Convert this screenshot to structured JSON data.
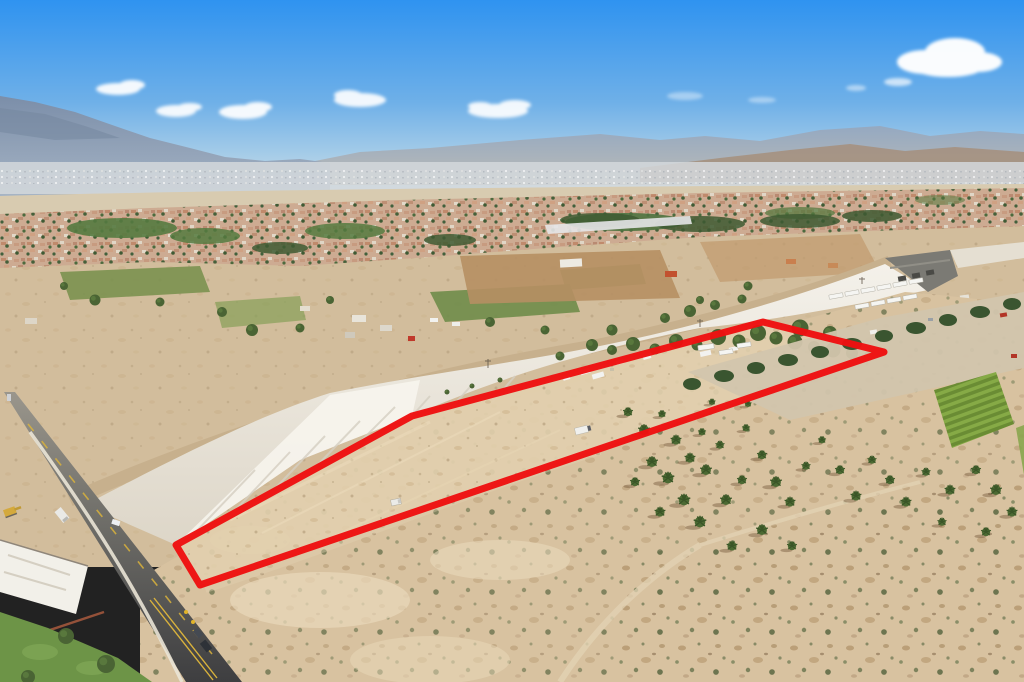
{
  "image": {
    "kind": "aerial-drone-photograph",
    "description": "Aerial view of a vacant desert land parcel outlined in red, running alongside a concrete flood-control channel, with palm groves and a trailer yard to the right, a two-lane road lower left, and a desert suburb with mountains under a blue sky in the background",
    "width_px": 1024,
    "height_px": 682
  },
  "parcel_outline": {
    "color": "#ee1111",
    "stroke_width": 7,
    "points": "176,545 368,440 412,416 763,322 884,352 200,585",
    "shape": "elongated irregular polygon",
    "purpose": "highlights subject vacant land parcel"
  },
  "palette": {
    "sky_top": "#2f93f0",
    "sky_horizon": "#d6e6ef",
    "cloud_white": "#ffffff",
    "mountain_left": "#7b8ea9",
    "mountain_far": "#97a5ba",
    "hills_right": "#a5917f",
    "valley_haze": "#d3d8dc",
    "desert_base": "#d2bd9c",
    "parcel_dirt": "#e2cfae",
    "foreground_scrub": "#d8c2a0",
    "channel_concrete": "#f2efe7",
    "channel_dirt_road": "#c7b08d",
    "road_asphalt": "#3e3e40",
    "road_centerline_yellow": "#d9b23c",
    "lawn_green": "#6d9447",
    "tree_green": "#4a6434",
    "palm_green": "#4c6a33",
    "crop_row_green": "#6a8c34",
    "container_red": "#c0392b"
  },
  "scene": {
    "sky": {
      "label": "clear blue sky",
      "cloud_count": 7
    },
    "background": [
      "blue-grey mountain range left",
      "hazy distant ridge across horizon",
      "tan foothills right",
      "white valley haze with distant city speckle"
    ],
    "midground": [
      "dense suburban rooftops with trees",
      "golf-course greens",
      "white mobile-home park strip",
      "rural ranches, dirt fields and green pastures",
      "red shipping container at ranch compound"
    ],
    "infrastructure": [
      "concrete flood-control channel running diagonally",
      "dirt maintenance road along channel top",
      "channel bridge crossing upper right",
      "concrete spur channel lower left",
      "two-lane asphalt road lower left with vehicles and sidewalk",
      "utility poles along channel"
    ],
    "parcel_contents": [
      "graded vacant desert land",
      "white box truck",
      "white pickup truck",
      "rv trailers near north edge",
      "tamarisk tree row along north edge"
    ],
    "right_side": [
      "fan-palm groves",
      "semi-trailer parking yard",
      "dark windbreak tree row",
      "bright green crop field rows"
    ],
    "foreground": [
      "creosote desert scrub",
      "sandy tire tracks",
      "green lawn corner with trees lower left"
    ]
  }
}
